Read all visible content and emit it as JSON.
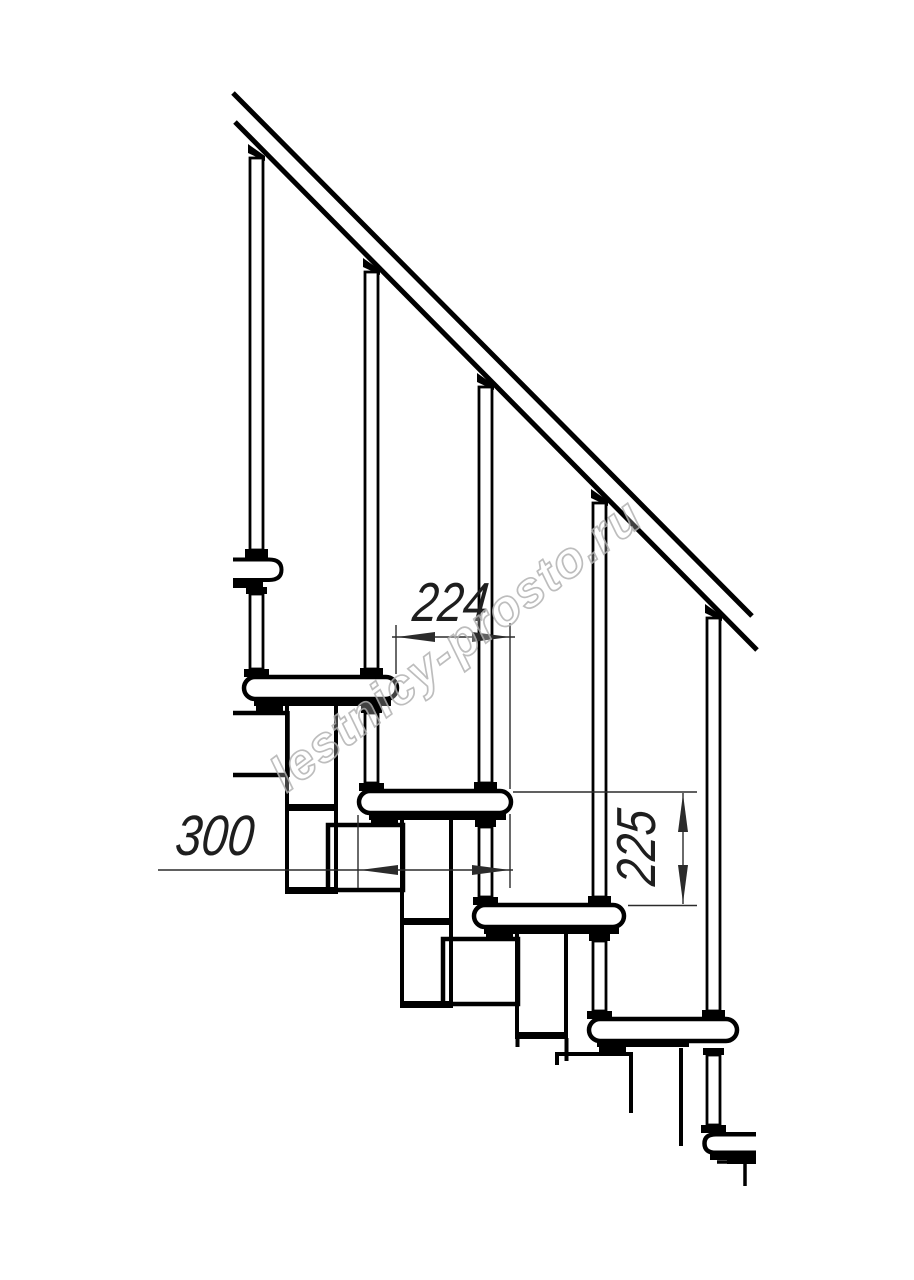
{
  "page": {
    "background": "#ffffff"
  },
  "drawing": {
    "line_color": "#000000",
    "dimension_color": "#2b2b2b",
    "dimensions": {
      "run": "224",
      "tread": "300",
      "rise": "225"
    },
    "watermark": {
      "text": "lestnicy-prosto.ru",
      "color": "#b2b2b2"
    }
  }
}
